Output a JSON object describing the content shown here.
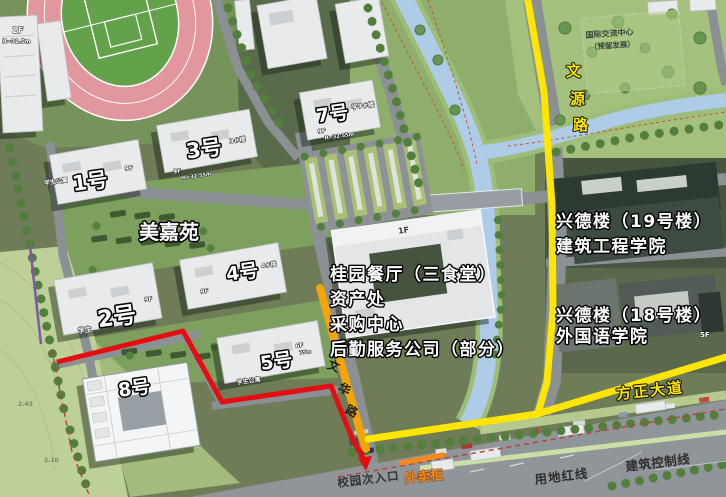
{
  "colors": {
    "route_red": "#e60d12",
    "route_yellow": "#ffe600",
    "road_orange": "#f2a50a",
    "takeout_orange": "#f6891e",
    "canal_blue": "#aecbe8",
    "track_pink": "#e2979f",
    "field_green": "#63a24b"
  },
  "labels": {
    "buildings": {
      "b2f": {
        "label": "2F",
        "height": "H=32.5m"
      },
      "b1": {
        "label": "1号",
        "sub": "学生公寓",
        "floors": "9F"
      },
      "b3": {
        "label": "3号",
        "sub": "3#楼",
        "floors": "9F",
        "height": "H=32.55m"
      },
      "b7": {
        "label": "7号",
        "sub": "学7#楼",
        "floors": "9F",
        "height": "H=32.55m"
      },
      "b4": {
        "label": "4号",
        "sub": "4#楼",
        "floors": "9F"
      },
      "b2": {
        "label": "2号",
        "sub": "学生",
        "floors": "9F"
      },
      "b5": {
        "label": "5号",
        "sub": "学生公寓",
        "floors": "6F",
        "height": "75m"
      },
      "b8": {
        "label": "8号"
      },
      "dining_floors": "1F",
      "b18_floors": "5F"
    },
    "complex": "美嘉苑",
    "dining_annotations": [
      "桂园餐厅（三食堂）",
      "资产处",
      "采购中心",
      "后勤服务公司（部分）"
    ],
    "right_buildings": {
      "b19": "兴德楼（19号楼）",
      "b19_dept": "建筑工程学院",
      "b18": "兴德楼（18号楼）",
      "b18_dept": "外国语学院"
    },
    "intl_center": {
      "line1": "国际交流中心",
      "line2": "（预留发展）"
    },
    "roads": {
      "wenyuan": [
        "文",
        "源",
        "路"
      ],
      "wenhua": [
        "文",
        "华",
        "路"
      ],
      "fangzheng": "方正大道"
    },
    "bottom": {
      "entrance": "校园次入口",
      "takeout": "外卖柜",
      "land_red_line": "用地红线",
      "building_control_line": "建筑控制线"
    },
    "elevations": [
      "2.43",
      "2.10"
    ]
  }
}
